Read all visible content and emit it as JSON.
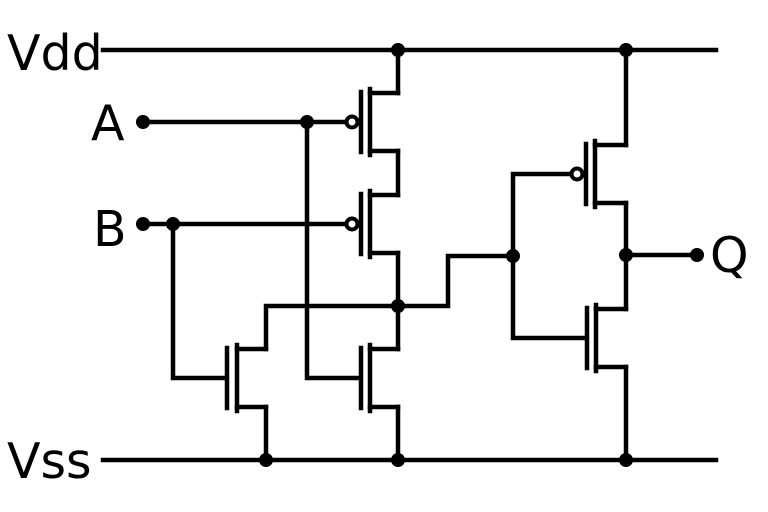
{
  "diagram": {
    "canvas": {
      "width": 768,
      "height": 512,
      "background": "#ffffff"
    },
    "style": {
      "stroke": "#000000",
      "stroke_width": 4.5,
      "dot_radius": 7,
      "bubble_radius": 5.5,
      "bubble_stroke_width": 4,
      "geometry": {
        "channel_half": 33,
        "stub_offset": 29,
        "gate_half": 30,
        "bubble_offset": 9
      }
    },
    "labels": {
      "vdd": "Vdd",
      "input_a": "A",
      "input_b": "B",
      "vss": "Vss",
      "output_q": "Q"
    },
    "wires": [
      {
        "name": "vdd-rail",
        "points": [
          [
            103,
            50
          ],
          [
            716,
            50
          ]
        ]
      },
      {
        "name": "vss-rail",
        "points": [
          [
            103,
            460
          ],
          [
            716,
            460
          ]
        ]
      },
      {
        "name": "input-a-wire",
        "points": [
          [
            143,
            122
          ],
          [
            348,
            122
          ]
        ]
      },
      {
        "name": "input-b-wire",
        "points": [
          [
            143,
            224
          ],
          [
            348,
            224
          ]
        ]
      },
      {
        "name": "a-branch-to-nmos",
        "points": [
          [
            307,
            122
          ],
          [
            307,
            378
          ],
          [
            359,
            378
          ]
        ]
      },
      {
        "name": "b-branch-to-nmos",
        "points": [
          [
            173,
            224
          ],
          [
            173,
            378
          ],
          [
            225,
            378
          ]
        ]
      },
      {
        "name": "vdd-to-pmos-a",
        "points": [
          [
            398,
            50
          ],
          [
            398,
            93
          ]
        ]
      },
      {
        "name": "pmos-series-link",
        "points": [
          [
            398,
            151
          ],
          [
            398,
            195
          ]
        ]
      },
      {
        "name": "pmos-b-to-nmos-a",
        "points": [
          [
            398,
            253
          ],
          [
            398,
            349
          ]
        ]
      },
      {
        "name": "node-to-nmos-b",
        "points": [
          [
            398,
            306
          ],
          [
            266,
            306
          ],
          [
            266,
            349
          ]
        ]
      },
      {
        "name": "nmos-b-to-vss",
        "points": [
          [
            266,
            407
          ],
          [
            266,
            460
          ]
        ]
      },
      {
        "name": "nmos-a-to-vss",
        "points": [
          [
            398,
            407
          ],
          [
            398,
            460
          ]
        ]
      },
      {
        "name": "node-to-inverter",
        "points": [
          [
            398,
            306
          ],
          [
            448,
            306
          ],
          [
            448,
            256
          ],
          [
            513,
            256
          ]
        ]
      },
      {
        "name": "inverter-gate-hookup",
        "points": [
          [
            570,
            174
          ],
          [
            513,
            174
          ],
          [
            513,
            338
          ],
          [
            585,
            338
          ]
        ]
      },
      {
        "name": "vdd-to-pmos-inv",
        "points": [
          [
            626,
            50
          ],
          [
            626,
            145
          ]
        ]
      },
      {
        "name": "inverter-output-link",
        "points": [
          [
            626,
            203
          ],
          [
            626,
            309
          ]
        ]
      },
      {
        "name": "nmos-inv-to-vss",
        "points": [
          [
            626,
            367
          ],
          [
            626,
            460
          ]
        ]
      },
      {
        "name": "output-q-wire",
        "points": [
          [
            626,
            255
          ],
          [
            697,
            255
          ]
        ]
      }
    ],
    "transistors": [
      {
        "name": "pmos-input-a",
        "type": "pmos",
        "channel_x": 370,
        "cy": 122,
        "stub_x": 398,
        "gate_x": 361
      },
      {
        "name": "pmos-input-b",
        "type": "pmos",
        "channel_x": 370,
        "cy": 224,
        "stub_x": 398,
        "gate_x": 361
      },
      {
        "name": "nmos-input-b",
        "type": "nmos",
        "channel_x": 237,
        "cy": 378,
        "stub_x": 266,
        "gate_x": 227
      },
      {
        "name": "nmos-input-a",
        "type": "nmos",
        "channel_x": 370,
        "cy": 378,
        "stub_x": 398,
        "gate_x": 361
      },
      {
        "name": "pmos-inverter",
        "type": "pmos",
        "channel_x": 595,
        "cy": 174,
        "stub_x": 626,
        "gate_x": 586
      },
      {
        "name": "nmos-inverter",
        "type": "nmos",
        "channel_x": 596,
        "cy": 338,
        "stub_x": 626,
        "gate_x": 587
      }
    ],
    "junctions": [
      {
        "name": "vdd-junction-left",
        "x": 398,
        "y": 50
      },
      {
        "name": "vdd-junction-right",
        "x": 626,
        "y": 50
      },
      {
        "name": "a-wire-junction",
        "x": 307,
        "y": 122
      },
      {
        "name": "b-wire-junction",
        "x": 173,
        "y": 224
      },
      {
        "name": "nor-output-node",
        "x": 398,
        "y": 306
      },
      {
        "name": "inverter-input-node",
        "x": 513,
        "y": 256
      },
      {
        "name": "inverter-output-node",
        "x": 626,
        "y": 255
      },
      {
        "name": "vss-junction-left",
        "x": 266,
        "y": 460
      },
      {
        "name": "vss-junction-middle",
        "x": 398,
        "y": 460
      },
      {
        "name": "vss-junction-right",
        "x": 626,
        "y": 460
      }
    ],
    "terminals": [
      {
        "name": "input-a-terminal",
        "x": 143,
        "y": 122
      },
      {
        "name": "input-b-terminal",
        "x": 143,
        "y": 224
      },
      {
        "name": "output-q-terminal",
        "x": 697,
        "y": 255
      }
    ]
  }
}
